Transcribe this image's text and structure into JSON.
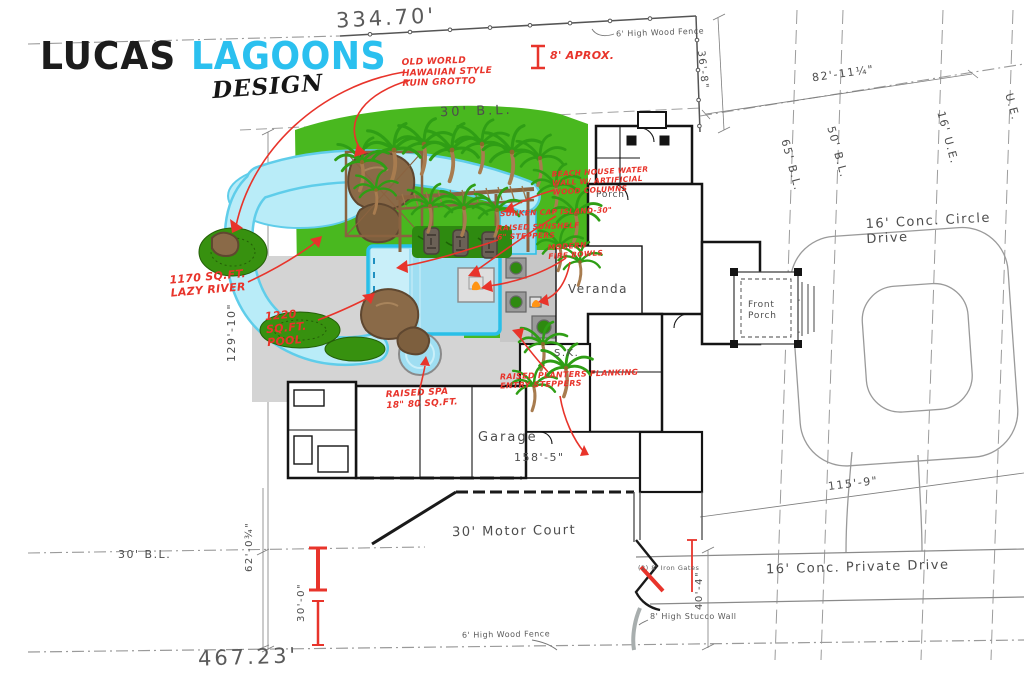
{
  "logo": {
    "lucas": "LUCAS",
    "lagoons": "LAGOONS",
    "design": "DESIGN"
  },
  "colors": {
    "lagoons_cyan": "#2bc0ef",
    "brush_green": "#3fc32c",
    "annotation_red": "#e8342b",
    "lawn_green": "#49b81f",
    "water_blue": "#b9ecf8",
    "pool_edge_cyan": "#29bfe8",
    "deck_gray": "#d4d4d4"
  },
  "boundary_dims": {
    "top": "334.70'",
    "bottom": "467.23'",
    "left": "129'-10\"",
    "right_upper": "36'-8\"",
    "northeast": "82'-11¼\""
  },
  "setback_labels": {
    "top_bl": "30' B.L.",
    "left_bl": "30' B.L.",
    "bl_65": "65' B.L.",
    "bl_50": "50' B.L.",
    "ue_16": "16' U.E.",
    "ue_edge": "U.E."
  },
  "site_dims": {
    "house_front": "158'-5\"",
    "court_side": "62'-0¾\"",
    "gate_span": "30'-0\"",
    "drive_width": "40'-4\"",
    "drive_run": "115'-9\""
  },
  "site_labels": {
    "circle_drive": "16' Conc. Circle Drive",
    "private_drive": "16' Conc. Private Drive",
    "motor_court": "30' Motor Court",
    "wood_fence_top": "6' High Wood Fence",
    "wood_fence_bottom": "6' High Wood Fence",
    "stucco_wall": "8' High Stucco Wall",
    "iron_gates": "(2) 8' Iron Gates"
  },
  "house_labels": {
    "veranda": "Veranda",
    "front_porch": "Front Porch",
    "porch": "Porch",
    "garage": "Garage",
    "sink": "S.K."
  },
  "annotations": {
    "grotto": "OLD WORLD HAWAIIAN STYLE RUIN GROTTO",
    "approx": "8' APROX.",
    "beach_house": "BEACH HOUSE WATER WALL W/ ARTIFICIAL WOOD COLUMNS",
    "island": "SUNKEN CAP ISLAND-30\"",
    "sunshelf": "RAISED SUNSHELF 6\" STEPPERS",
    "fire_bowls": "MODERN FIRE BOWLS",
    "lazy_river": "1170 SQ.FT. LAZY RIVER",
    "pool": "1220 SQ.FT. POOL",
    "spa": "RAISED SPA 18\" 80 SQ.FT.",
    "planters": "RAISED PLANTERS FLANKING ENTRY STEPPERS"
  }
}
